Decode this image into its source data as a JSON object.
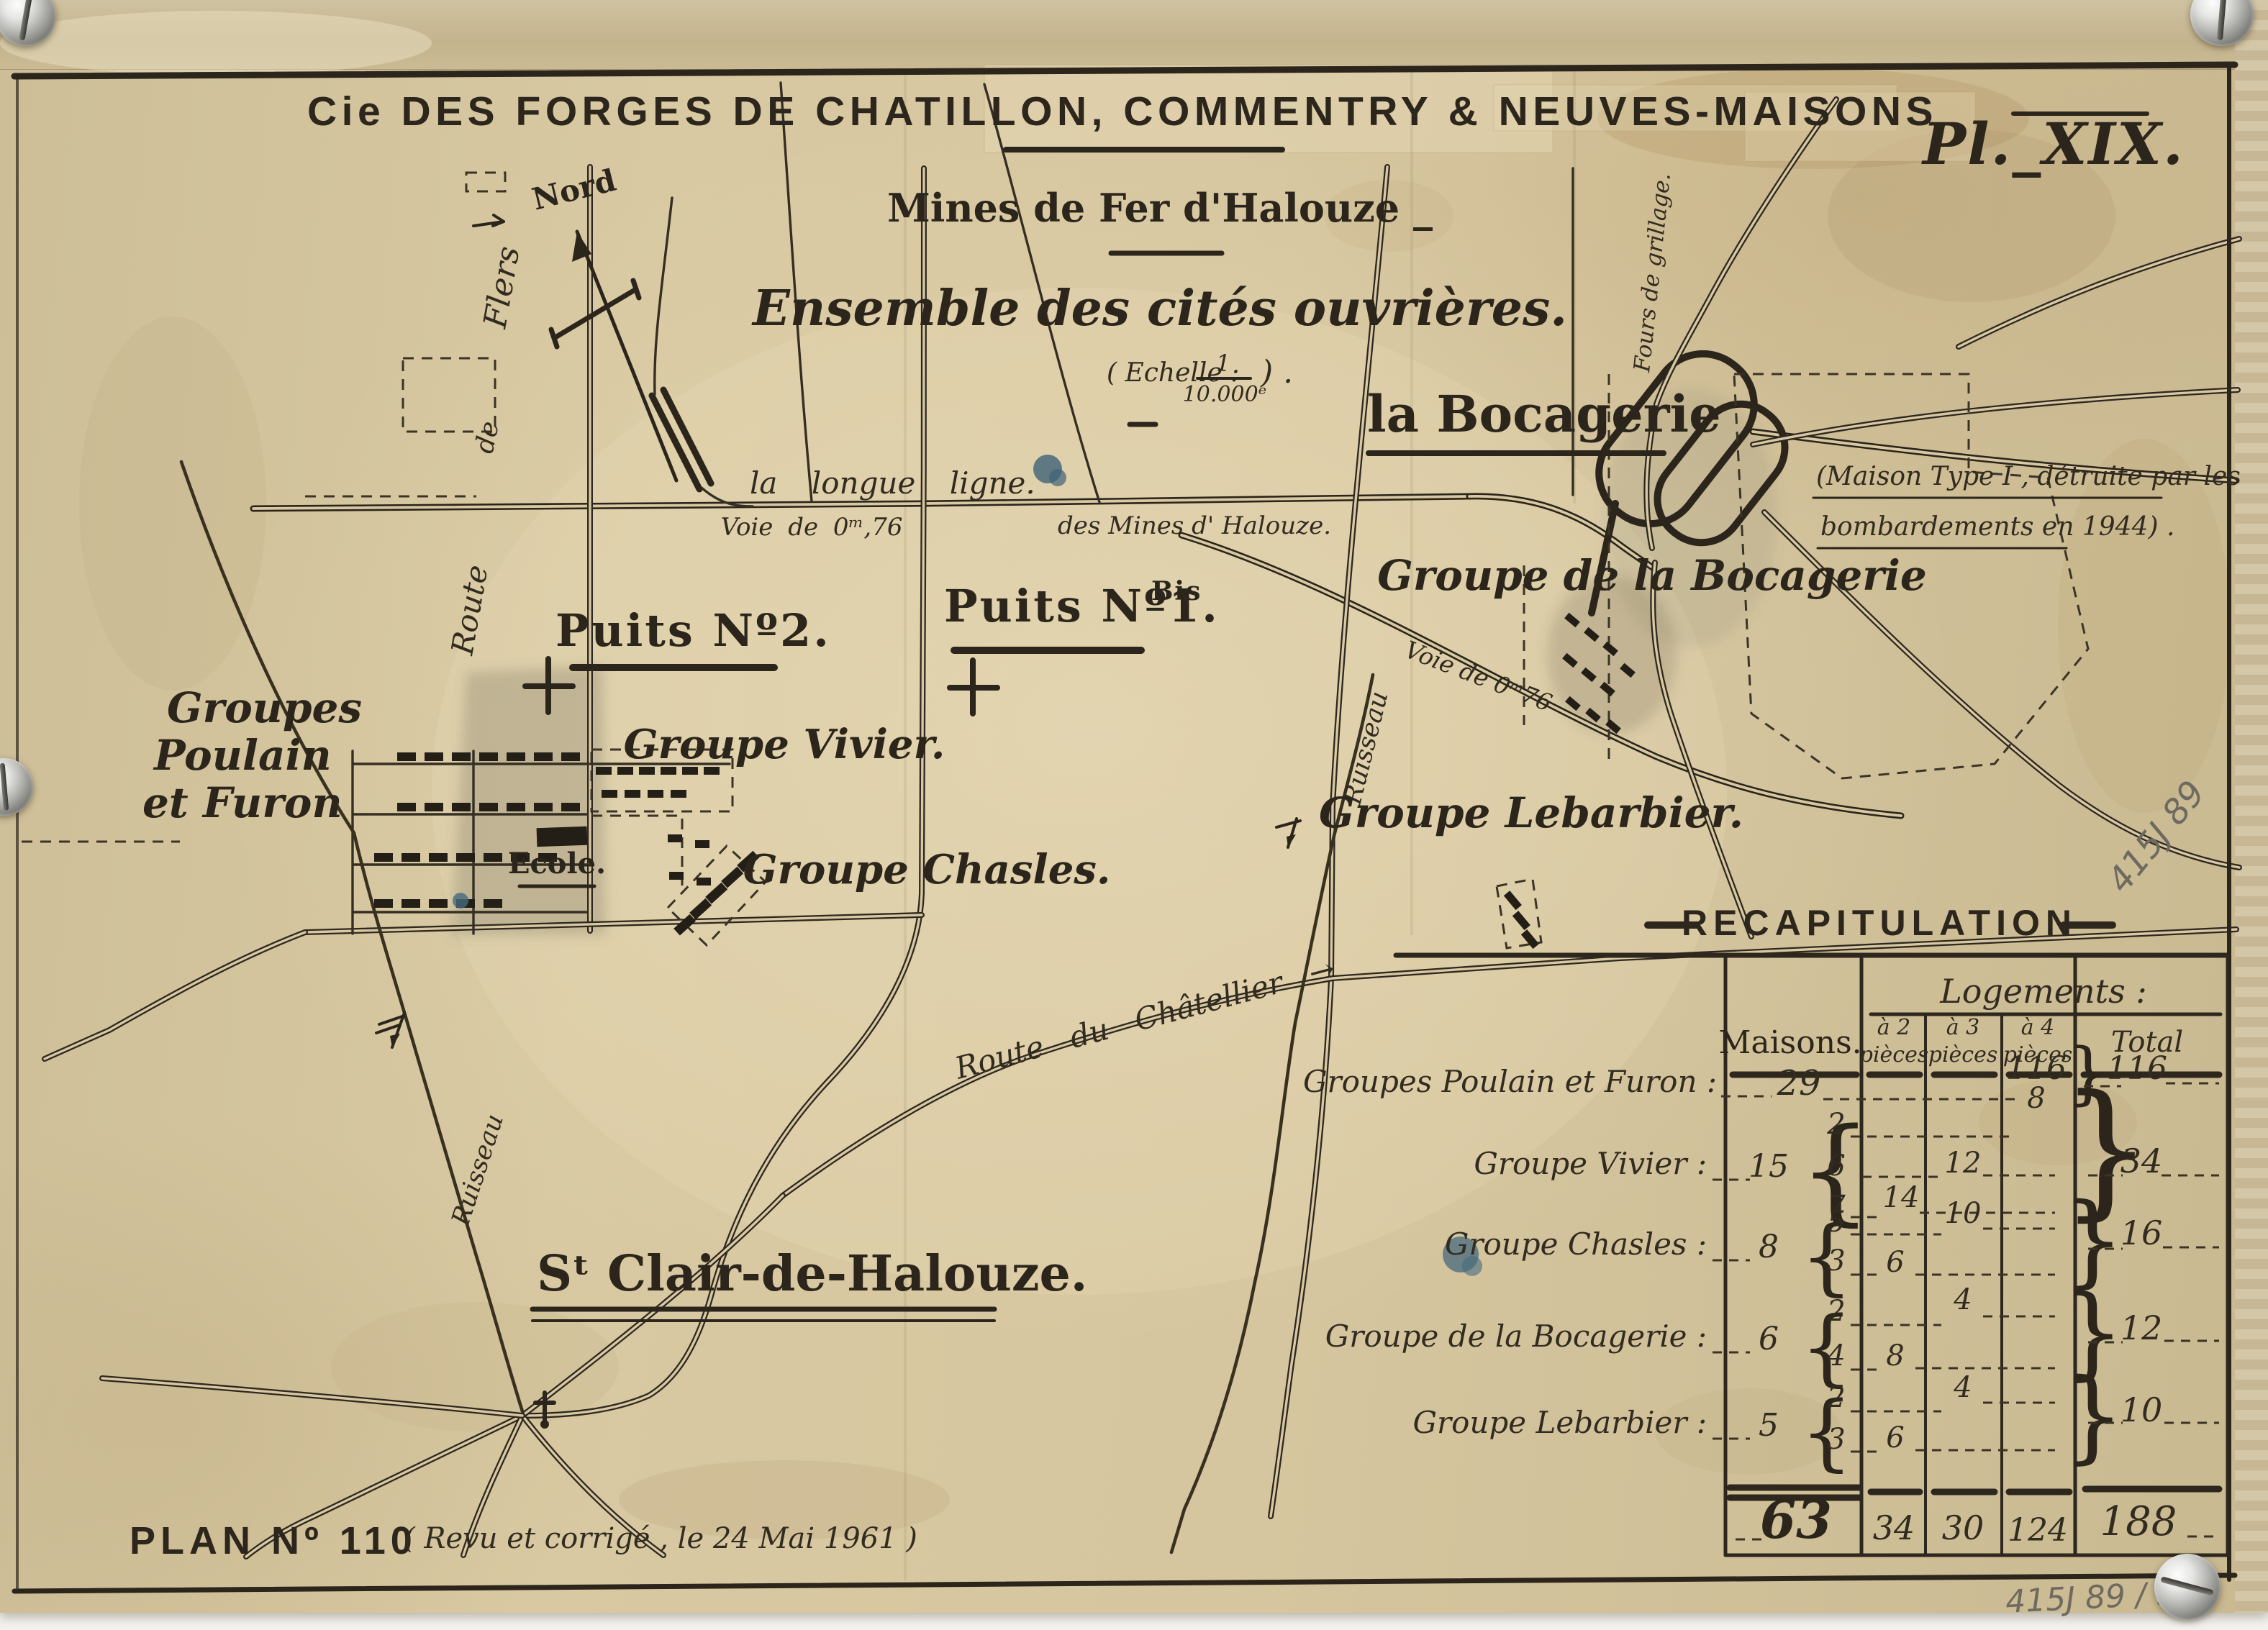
{
  "header": {
    "title": "Cie DES FORGES DE CHATILLON, COMMENTRY & NEUVES-MAISONS",
    "plate": "Pl._XIX.",
    "subtitle": "Mines de Fer d'Halouze _",
    "ensemble": "Ensemble des cités ouvrières.",
    "scale_open": "( Echelle :",
    "scale_num": "1",
    "scale_den": "10.000ᵉ",
    "scale_close": ") ."
  },
  "compass": {
    "north": "Nord"
  },
  "roads": {
    "route": "Route",
    "de": "de",
    "flers": "Flers",
    "longue": "la longue ligne.",
    "voie_h": "Voie de 0ᵐ,76",
    "des_mines": "des Mines d' Halouze.",
    "voie_diag": "Voie de 0ᵐ76",
    "chatellier": "Route du Châtellier →",
    "ruisseau_left": "Ruisseau",
    "ruisseau_mid": "Ruisseau"
  },
  "sites": {
    "puits2": "Puits Nº2.",
    "puits1": "Puits Nº1.",
    "puits1_sup": "Bis",
    "bocagerie": "la Bocagerie",
    "fours": "Fours de grillage.",
    "groupe_bocagerie": "Groupe de la Bocagerie",
    "poulain1": "Groupes",
    "poulain2": "Poulain",
    "poulain3": "et Furon",
    "vivier": "Groupe Vivier.",
    "ecole": "Ecole.",
    "chasles": "Groupe Chasles.",
    "lebarbier": "Groupe Lebarbier.",
    "st_clair": "Sᵗ Clair-de-Halouze."
  },
  "note": {
    "line1": "(Maison Type I , détruite par les",
    "line2": "bombardements en 1944) ."
  },
  "table": {
    "title": "RECAPITULATION",
    "logements": "Logements :",
    "col_maisons": "Maisons.",
    "col_p2a": "à 2",
    "col_p2b": "pièces",
    "col_p3a": "à 3",
    "col_p3b": "pièces",
    "col_p4a": "à 4",
    "col_p4b": "pièces",
    "col_total": "Total",
    "brace_open": "{",
    "brace_close": "}",
    "rows": [
      {
        "label": "Groupes Poulain et Furon :",
        "maisons": "29",
        "p4": "116",
        "total": "116"
      },
      {
        "label": "Groupe Vivier :",
        "maisons": "15",
        "m1": "2",
        "m2": "6",
        "m3": "7",
        "v_p4": "8",
        "v_p3": "12",
        "v_p2": "14",
        "total": "34"
      },
      {
        "label": "Groupe Chasles :",
        "maisons": "8",
        "m1": "5",
        "m2": "3",
        "v_p3": "10",
        "v_p2": "6",
        "total": "16"
      },
      {
        "label": "Groupe de la Bocagerie :",
        "maisons": "6",
        "m1": "2",
        "m2": "4",
        "v_p3": "4",
        "v_p2": "8",
        "total": "12"
      },
      {
        "label": "Groupe Lebarbier :",
        "maisons": "5",
        "m1": "2",
        "m2": "3",
        "v_p3": "4",
        "v_p2": "6",
        "total": "10"
      }
    ],
    "totals": {
      "maisons": "63",
      "p2": "34",
      "p3": "30",
      "p4": "124",
      "total": "188"
    }
  },
  "footer": {
    "plan": "PLAN Nº 110",
    "revision": "( Revu et corrigé , le 24 Mai 1961 )"
  },
  "annotations": {
    "cote_diag": "415J 89",
    "cote_bottom": "415J  89 / 5"
  }
}
